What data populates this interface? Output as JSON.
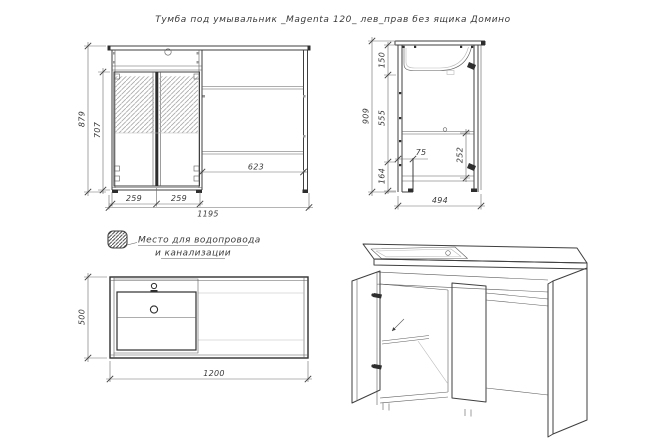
{
  "title": "Тумба под умывальник _Magenta 120_ лев_прав без ящика Домино",
  "legend": {
    "icon": "plumbing-hatch-square",
    "line1": "Место для водопровода",
    "line2": "и канализации"
  },
  "views": {
    "front": {
      "label": "front-elevation",
      "dims": {
        "total_height": "879",
        "interior_height": "707",
        "door_left_width": "259",
        "door_right_width": "259",
        "open_section_width": "623",
        "total_width": "1195"
      }
    },
    "side": {
      "label": "side-section",
      "dims": {
        "total_height": "909",
        "top_segment": "150",
        "middle_segment": "555",
        "bottom_segment": "164",
        "plinth_depth": "75",
        "shelf_clearance": "252",
        "depth": "494"
      }
    },
    "plan": {
      "label": "top-plan",
      "dims": {
        "depth": "500",
        "width": "1200"
      }
    },
    "iso": {
      "label": "isometric-3d-view"
    }
  },
  "colors": {
    "line": "#3f3f3f",
    "dimension": "#6a6a6a",
    "hatch_light": "#a8a8a8",
    "hatch_dark": "#555555",
    "background": "#ffffff",
    "text": "#3a3a3a"
  }
}
